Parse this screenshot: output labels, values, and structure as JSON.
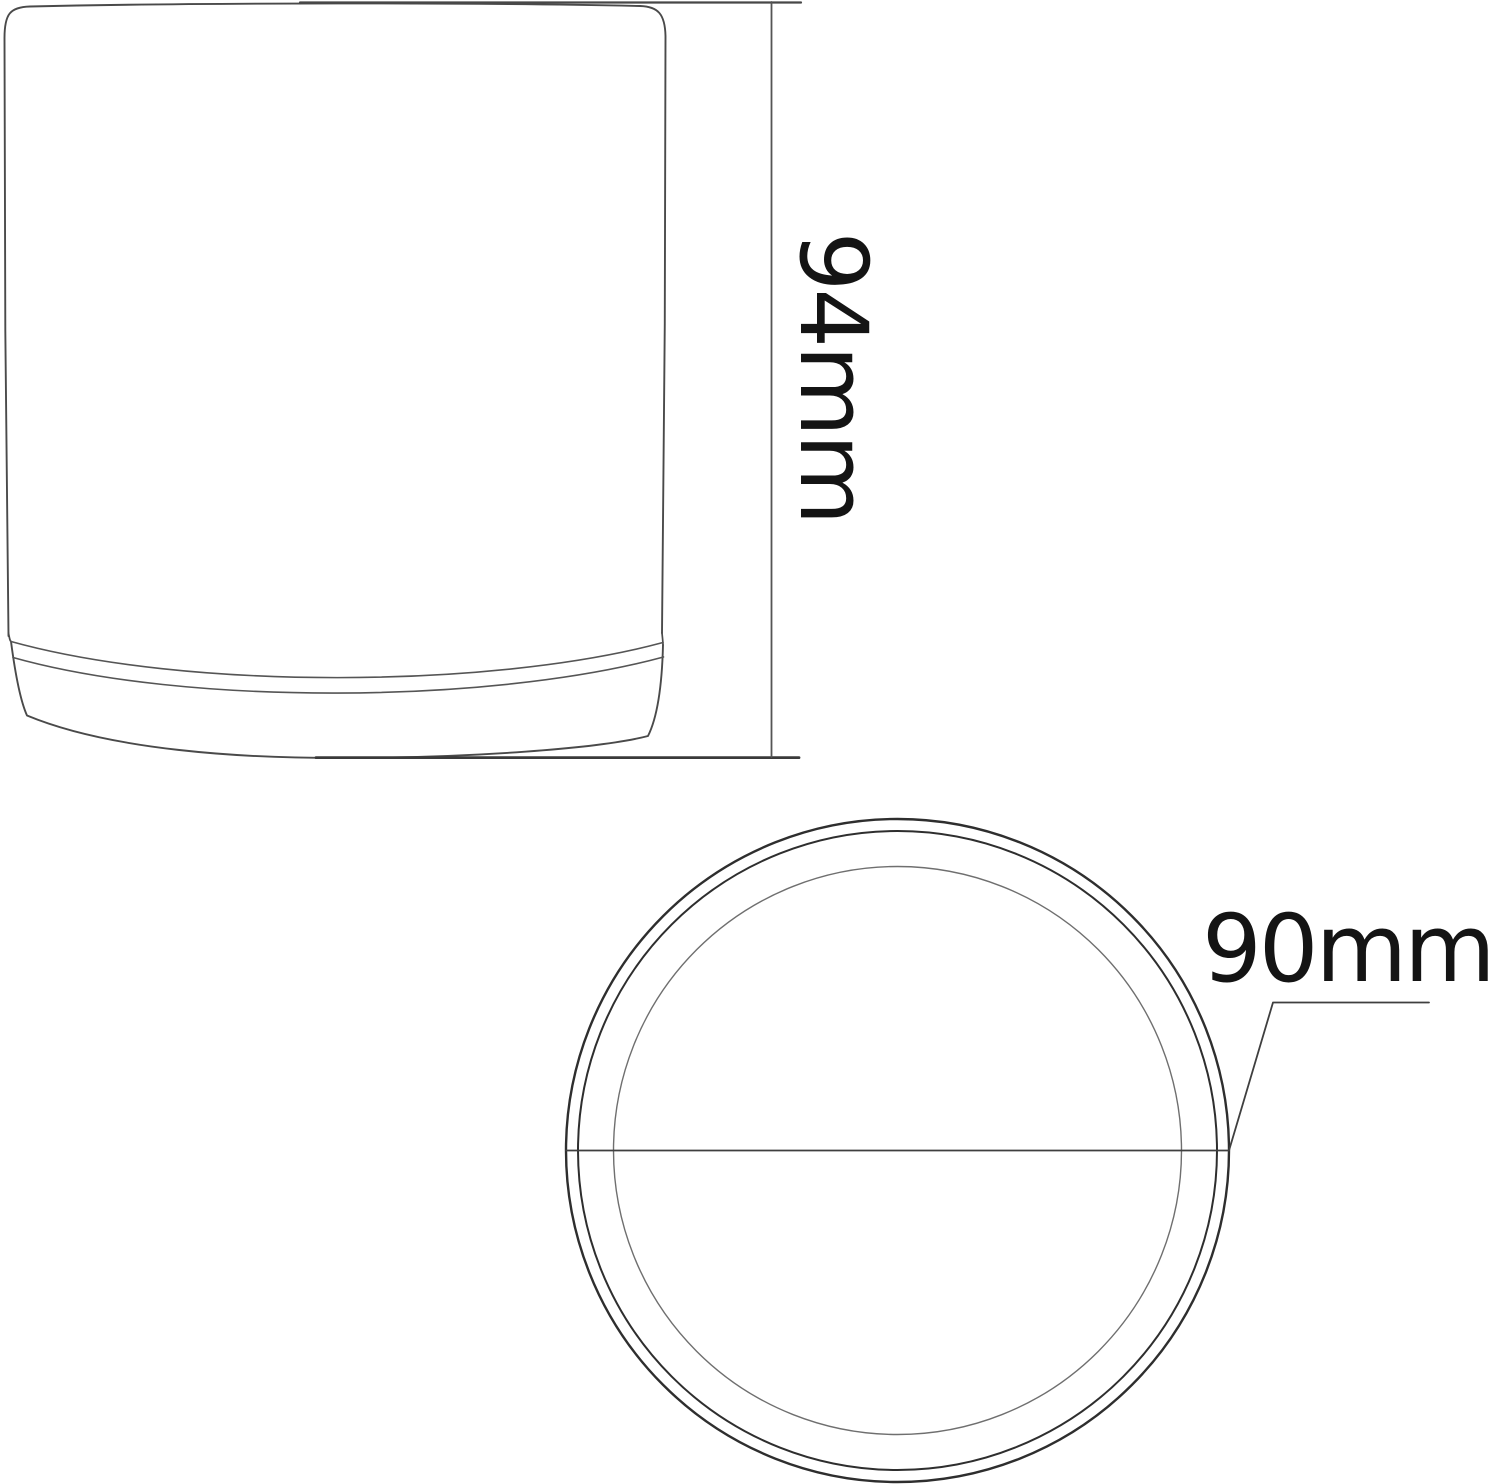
{
  "drawing": {
    "type": "technical-dimension-diagram",
    "subject": "cylindrical pot / fixture outline drawing",
    "views": [
      {
        "id": "side-view",
        "description": "side elevation of cylinder with base ring"
      },
      {
        "id": "top-view",
        "description": "circular plan view with three concentric rims and diameter line"
      }
    ],
    "dimensions": {
      "height": {
        "label": "94mm",
        "orientation": "vertical"
      },
      "diameter": {
        "label": "90mm",
        "orientation": "horizontal"
      }
    },
    "colors": {
      "background": "#ffffff",
      "outline": "#4a4a4a",
      "outline_dark": "#2e2e2e",
      "outline_light": "#6f6f6f",
      "text": "#141414"
    }
  }
}
